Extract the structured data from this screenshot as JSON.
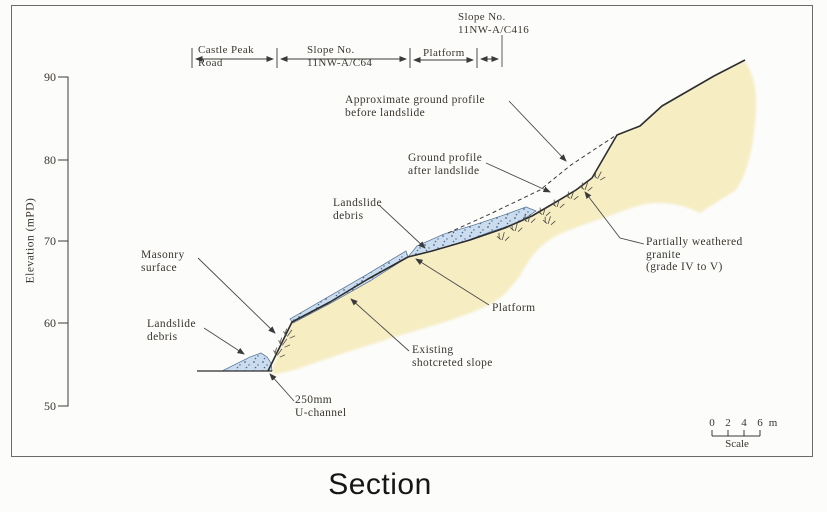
{
  "title": "Section",
  "axis": {
    "label": "Elevation (mPD)",
    "ticks": [
      "90",
      "80",
      "70",
      "60",
      "50"
    ]
  },
  "top_dimensions": {
    "castle_peak_road": "Castle Peak\nRoad",
    "slope_c64": "Slope No.\n11NW-A/C64",
    "platform": "Platform",
    "slope_c416": "Slope No.\n11NW-A/C416"
  },
  "annotations": {
    "approx_profile": "Approximate ground profile\nbefore landslide",
    "after_profile": "Ground profile\nafter landslide",
    "landslide_debris_mid": "Landslide\ndebris",
    "masonry": "Masonry\nsurface",
    "granite": "Partially weathered\ngranite\n(grade IV to V)",
    "platform_slope": "Platform",
    "landslide_debris_low": "Landslide\ndebris",
    "shotcrete": "Existing\nshotcreted slope",
    "uchannel": "250mm\nU-channel"
  },
  "scalebar": {
    "ticks": [
      "0",
      "2",
      "4",
      "6"
    ],
    "unit": "m",
    "label": "Scale"
  },
  "colors": {
    "granite_fill": "#f6edc3",
    "debris_fill": "#cadcee",
    "debris_dots": "#46688f",
    "line": "#2d2d2d"
  }
}
